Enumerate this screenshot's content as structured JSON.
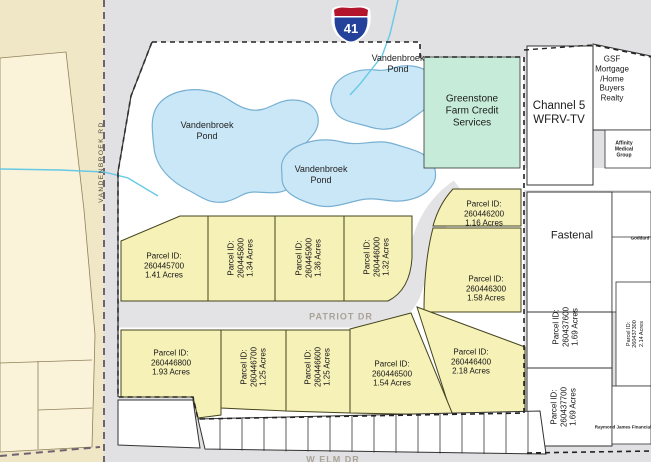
{
  "shield": {
    "number": "41"
  },
  "pond_labels": [
    "Vandenbroek\nPond",
    "Vandenbroek\nPond",
    "Vandenbroek\nPond"
  ],
  "roads": {
    "patriot_dr": "PATRIOT DR",
    "w_elm_dr": "W ELM DR",
    "vandenbroek_rd": "VANDENBROEK RD"
  },
  "parcels": [
    {
      "label": "Parcel ID:",
      "id": "260445700",
      "acres": "1.41 Acres"
    },
    {
      "label": "Parcel ID:",
      "id": "260445800",
      "acres": "1.34 Acres"
    },
    {
      "label": "Parcel ID:",
      "id": "260445900",
      "acres": "1.36 Acres"
    },
    {
      "label": "Parcel ID:",
      "id": "260446000",
      "acres": "1.32 Acres"
    },
    {
      "label": "Parcel ID:",
      "id": "260446200",
      "acres": "1.16 Acres"
    },
    {
      "label": "Parcel ID:",
      "id": "260446300",
      "acres": "1.58 Acres"
    },
    {
      "label": "Parcel ID:",
      "id": "260446400",
      "acres": "2.18 Acres"
    },
    {
      "label": "Parcel ID:",
      "id": "260446500",
      "acres": "1.54 Acres"
    },
    {
      "label": "Parcel ID:",
      "id": "260446600",
      "acres": "1.25 Acres"
    },
    {
      "label": "Parcel ID:",
      "id": "260446700",
      "acres": "1.25 Acres"
    },
    {
      "label": "Parcel ID:",
      "id": "260446800",
      "acres": "1.93 Acres"
    },
    {
      "label": "Parcel ID:",
      "id": "260437600",
      "acres": "1.69 Acres"
    },
    {
      "label": "Parcel ID:",
      "id": "260437700",
      "acres": "1.69 Acres"
    },
    {
      "label": "Parcel ID:",
      "id": "260437300",
      "acres": "2.14 Acres"
    }
  ],
  "businesses": {
    "greenstone": "Greenstone\nFarm Credit\nServices",
    "channel5": "Channel 5\nWFRV-TV",
    "gsf": "GSF Mortgage\n/Home Buyers\nRealty",
    "fastenal": "Fastenal",
    "affinity": "Affinity\nMedical\nGroup",
    "goddard": "Goddard",
    "raymond": "Raymond James Financial"
  },
  "colors": {
    "parcel_yellow": "#f6f1b7",
    "pond_blue": "#c9e7f7",
    "pond_edge": "#78b0d2",
    "greenstone_green": "#c6ecd9",
    "shield_blue": "#23409a",
    "shield_red": "#b3162c",
    "water_line": "#66c9e6",
    "tan_area": "#f0e7c6",
    "cream_area": "#faf3da"
  }
}
